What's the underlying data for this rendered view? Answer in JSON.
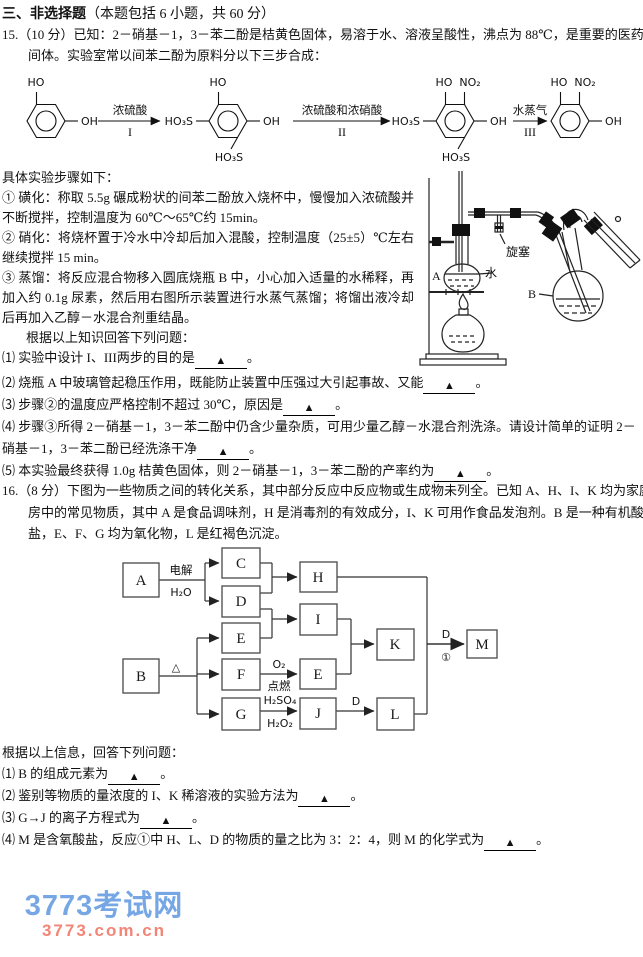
{
  "blanks": {
    "marker": "▲"
  },
  "section_heading": {
    "title_bold": "三、非选择题",
    "title_rest": "（本题包括 6 小题，共 60 分）"
  },
  "q15": {
    "intro": "15.（10 分）已知：2－硝基－1，3－苯二酚是桔黄色固体，易溶于水、溶液呈酸性，沸点为 88℃，是重要的医药中间体。实验室常以间苯二酚为原料分以下三步合成：",
    "scheme": {
      "groups": {
        "ho": "HO",
        "oh": "OH",
        "ho3s": "HO₃S",
        "no2": "NO₂"
      },
      "arrows": [
        {
          "top": "浓硫酸",
          "bottom": "I"
        },
        {
          "top": "浓硫酸和浓硝酸",
          "bottom": "II"
        },
        {
          "top": "水蒸气",
          "bottom": "III"
        }
      ]
    },
    "steps_intro": "具体实验步骤如下：",
    "steps": [
      "① 磺化：称取 5.5g 碾成粉状的间苯二酚放入烧杯中，慢慢加入浓硫酸并不断搅拌，控制温度为 60℃～65℃约 15min。",
      "② 硝化：将烧杯置于冷水中冷却后加入混酸，控制温度（25±5）℃左右继续搅拌 15 min。",
      "③ 蒸馏：将反应混合物移入圆底烧瓶 B 中，小心加入适量的水稀释，再加入约 0.1g 尿素，然后用右图所示装置进行水蒸气蒸馏；将馏出液冷却后再加入乙醇－水混合剂重结晶。"
    ],
    "answer_prompt": "根据以上知识回答下列问题：",
    "questions": [
      {
        "label": "⑴",
        "text": "实验中设计 I、III两步的目的是",
        "suffix": "。"
      },
      {
        "label": "⑵",
        "text": "烧瓶 A 中玻璃管起稳压作用，既能防止装置中压强过大引起事故、又能",
        "suffix": "。"
      },
      {
        "label": "⑶",
        "text": "步骤②的温度应严格控制不超过 30℃，原因是",
        "suffix": "。"
      },
      {
        "label": "⑷",
        "text": "步骤③所得 2－硝基－1，3－苯二酚中仍含少量杂质，可用少量乙醇－水混合剂洗涤。请设计简单的证明 2－硝基－1，3－苯二酚已经洗涤干净",
        "suffix": "。"
      },
      {
        "label": "⑸",
        "text": "本实验最终获得 1.0g 桔黄色固体，则 2－硝基－1，3－苯二酚的产率约为",
        "suffix": "。"
      }
    ],
    "apparatus": {
      "flask_a": "A",
      "water": "水",
      "flask_b": "B",
      "stopcock": "旋塞"
    }
  },
  "q16": {
    "intro": "16.（8 分）下图为一些物质之间的转化关系，其中部分反应中反应物或生成物未列全。已知 A、H、I、K 均为家庭厨房中的常见物质，其中 A 是食品调味剂，H 是消毒剂的有效成分，I、K 可用作食品发泡剂。B 是一种有机酸盐，E、F、G 均为氧化物，L 是红褐色沉淀。",
    "flow": {
      "boxes": {
        "a": "A",
        "b": "B",
        "c": "C",
        "d": "D",
        "e1": "E",
        "e2": "E",
        "f": "F",
        "g": "G",
        "h": "H",
        "i": "I",
        "j": "J",
        "k": "K",
        "l": "L",
        "m": "M"
      },
      "edge_labels": {
        "electrolysis": "电解",
        "water": "H₂O",
        "heat": "△",
        "oxygen": "O₂",
        "ignite": "点燃",
        "sulfuric_acid": "H₂SO₄",
        "peroxide": "H₂O₂",
        "d_to_l": "D",
        "d_to_m": "D",
        "reaction1": "①"
      }
    },
    "answer_prompt": "根据以上信息，回答下列问题：",
    "questions": [
      {
        "label": "⑴",
        "text": "B 的组成元素为",
        "suffix": "。"
      },
      {
        "label": "⑵",
        "text": "鉴别等物质的量浓度的 I、K 稀溶液的实验方法为",
        "suffix": "。"
      },
      {
        "label": "⑶",
        "text": "G→J 的离子方程式为",
        "suffix": "。"
      },
      {
        "label": "⑷",
        "text": "M 是含氧酸盐，反应①中 H、L、D 的物质的量之比为 3：2：4，则 M 的化学式为",
        "suffix": "。"
      }
    ]
  },
  "watermark": {
    "line1": "3773考试网",
    "line2": "3773.com.cn",
    "color1": "#76a7e4",
    "color2": "#f28576"
  }
}
